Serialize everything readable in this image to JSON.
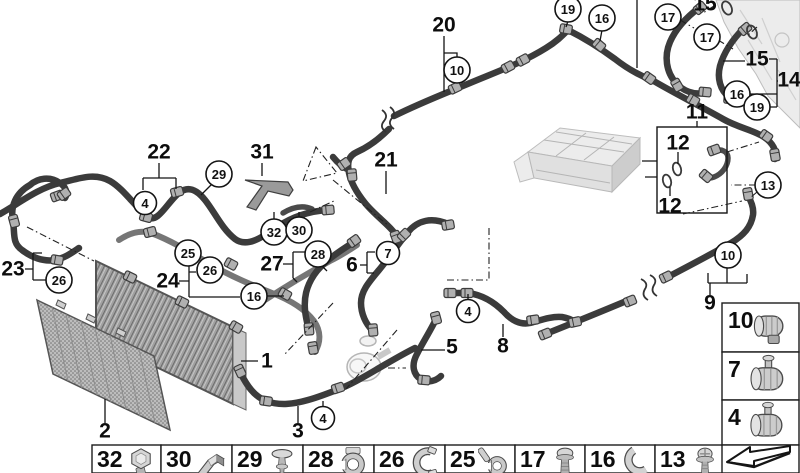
{
  "figure": {
    "balloons": [
      {
        "n": "4",
        "x": 145,
        "y": 203
      },
      {
        "n": "29",
        "x": 219,
        "y": 174
      },
      {
        "n": "32",
        "x": 274,
        "y": 232
      },
      {
        "n": "30",
        "x": 299,
        "y": 230
      },
      {
        "n": "25",
        "x": 188,
        "y": 253
      },
      {
        "n": "26",
        "x": 210,
        "y": 270
      },
      {
        "n": "16",
        "x": 254,
        "y": 296
      },
      {
        "n": "26",
        "x": 59,
        "y": 280
      },
      {
        "n": "28",
        "x": 318,
        "y": 254
      },
      {
        "n": "7",
        "x": 388,
        "y": 253
      },
      {
        "n": "4",
        "x": 468,
        "y": 311
      },
      {
        "n": "4",
        "x": 323,
        "y": 418
      },
      {
        "n": "10",
        "x": 457,
        "y": 70
      },
      {
        "n": "19",
        "x": 568,
        "y": 9
      },
      {
        "n": "16",
        "x": 602,
        "y": 18
      },
      {
        "n": "17",
        "x": 668,
        "y": 17
      },
      {
        "n": "17",
        "x": 707,
        "y": 37
      },
      {
        "n": "16",
        "x": 737,
        "y": 94
      },
      {
        "n": "19",
        "x": 757,
        "y": 107
      },
      {
        "n": "13",
        "x": 768,
        "y": 185
      },
      {
        "n": "10",
        "x": 728,
        "y": 255
      }
    ],
    "part_labels": [
      {
        "n": "20",
        "x": 444,
        "y": 25
      },
      {
        "n": "22",
        "x": 159,
        "y": 152
      },
      {
        "n": "31",
        "x": 262,
        "y": 152
      },
      {
        "n": "21",
        "x": 386,
        "y": 160
      },
      {
        "n": "23",
        "x": 13,
        "y": 269
      },
      {
        "n": "24",
        "x": 168,
        "y": 281
      },
      {
        "n": "27",
        "x": 272,
        "y": 264
      },
      {
        "n": "6",
        "x": 352,
        "y": 265
      },
      {
        "n": "5",
        "x": 452,
        "y": 347
      },
      {
        "n": "8",
        "x": 503,
        "y": 346
      },
      {
        "n": "3",
        "x": 298,
        "y": 431
      },
      {
        "n": "2",
        "x": 105,
        "y": 431
      },
      {
        "n": "1",
        "x": 267,
        "y": 361
      },
      {
        "n": "9",
        "x": 710,
        "y": 303
      },
      {
        "n": "11",
        "x": 697,
        "y": 112
      },
      {
        "n": "12",
        "x": 678,
        "y": 143
      },
      {
        "n": "12",
        "x": 670,
        "y": 206
      },
      {
        "n": "14",
        "x": 789,
        "y": 80
      },
      {
        "n": "15",
        "x": 705,
        "y": 4
      },
      {
        "n": "15",
        "x": 757,
        "y": 59
      }
    ],
    "legend_bottom": [
      {
        "num": "32",
        "icon": "hex-bolt"
      },
      {
        "num": "30",
        "icon": "holder-clip"
      },
      {
        "num": "29",
        "icon": "push-rivet"
      },
      {
        "num": "28",
        "icon": "hose-clip"
      },
      {
        "num": "26",
        "icon": "spring-clip"
      },
      {
        "num": "25",
        "icon": "retaining-clip"
      },
      {
        "num": "17",
        "icon": "pan-head-screw"
      },
      {
        "num": "16",
        "icon": "c-clip"
      },
      {
        "num": "13",
        "icon": "flange-screw"
      }
    ],
    "legend_right": [
      {
        "num": "10",
        "icon": "hose-clamp"
      },
      {
        "num": "7",
        "icon": "clamp-with-pin"
      },
      {
        "num": "4",
        "icon": "clamp-with-pin"
      }
    ],
    "corner_icon": "page-turn-arrow"
  }
}
